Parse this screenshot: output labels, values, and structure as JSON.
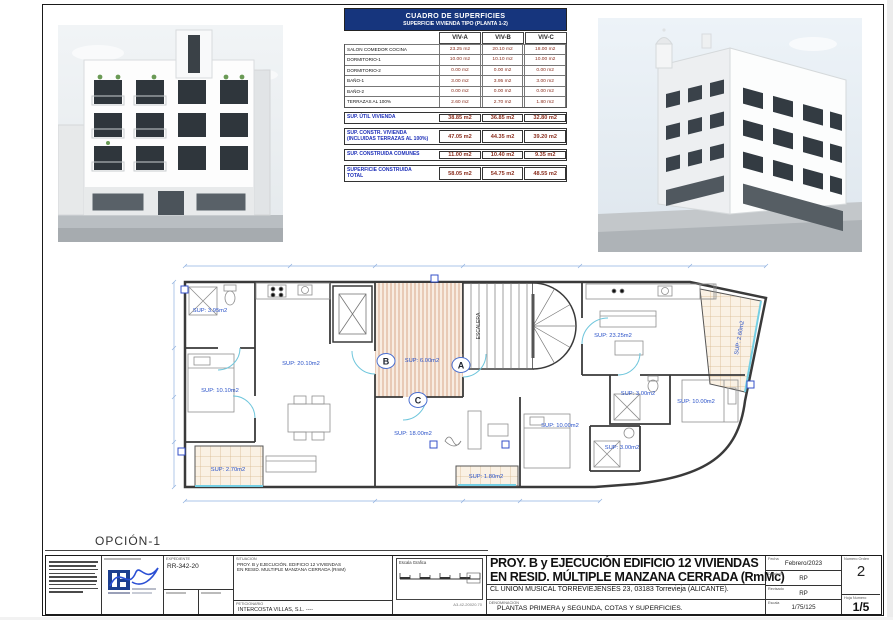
{
  "page": {
    "option_label": "OPCIÓN-1",
    "sheet_code": "A3-42-20020.70"
  },
  "surface_table": {
    "title": "CUADRO DE SUPERFICIES",
    "subtitle": "SUPERFICIE VIVIENDA TIPO  (PLANTA 1-2)",
    "columns": [
      "VIV-A",
      "VIV-B",
      "VIV-C"
    ],
    "rows": [
      {
        "label": "SALON COMEDOR COCINA",
        "values": [
          "23.25 m2",
          "20.10 m2",
          "18.00 m2"
        ]
      },
      {
        "label": "DORMITORIO-1",
        "values": [
          "10.00 m2",
          "10.10 m2",
          "10.00 m2"
        ]
      },
      {
        "label": "DORMITORIO-2",
        "values": [
          "0.00 m2",
          "0.00 m2",
          "0.00 m2"
        ]
      },
      {
        "label": "BAÑO-1",
        "values": [
          "3.00 m2",
          "3.95 m2",
          "3.00 m2"
        ]
      },
      {
        "label": "BAÑO-2",
        "values": [
          "0.00 m2",
          "0.00 m2",
          "0.00 m2"
        ]
      },
      {
        "label": "TERRAZAS AL 100%",
        "values": [
          "2.60 m2",
          "2.70 m2",
          "1.80 m2"
        ]
      }
    ],
    "summary": [
      {
        "label": "SUP. ÚTIL VIVIENDA",
        "label2": "",
        "values": [
          "38.85 m2",
          "36.85 m2",
          "32.80 m2"
        ]
      },
      {
        "label": "SUP. CONSTR. VIVIENDA",
        "label2": "(INCLUIDAS TERRAZAS AL 100%)",
        "values": [
          "47.05 m2",
          "44.35 m2",
          "39.20 m2"
        ]
      },
      {
        "label": "SUP. CONSTRUIDA COMUNES",
        "label2": "",
        "values": [
          "11.00 m2",
          "10.40 m2",
          "9.35 m2"
        ]
      },
      {
        "label": "SUPERFICIE CONSTRUIDA",
        "label2": "TOTAL",
        "values": [
          "58.05 m2",
          "54.75 m2",
          "48.55 m2"
        ]
      }
    ]
  },
  "plan": {
    "stair_label": "ESCALERA",
    "door_tags": [
      "A",
      "B",
      "C"
    ],
    "labels": {
      "bath_b": "SUP: 3.95m2",
      "bedroom_b": "SUP: 10.10m2",
      "terrace_b": "SUP: 2.70m2",
      "salon_b": "SUP: 20.10m2",
      "hall": "SUP: 6.00m2",
      "salon_a": "SUP: 23.25m2",
      "terrace_a": "SUP: 2.60m2",
      "bath_a": "SUP: 3.00m2",
      "bedroom_a": "SUP: 10.00m2",
      "salon_c": "SUP: 18.00m2",
      "bedroom_c": "SUP: 10.00m2",
      "bath_c": "SUP: 3.00m2",
      "terrace_c": "SUP: 1.80m2"
    }
  },
  "titleblock": {
    "expediente_label": "EXPEDIENTE",
    "expediente": "RR-342-20",
    "situacion_label": "SITUACION",
    "project_small_1": "PROY. B y EJECUCIÓN. EDIFICIO 12 VIVIENDAS",
    "project_small_2": "EN RESID. MULTIPLE MANZANA CERRADA (RmM)",
    "peticionario_label": "PETICIONARIO",
    "peticionario": "INTERCOSTA VILLAS, S.L. ----",
    "scale_bar_label": "Escala Grafica",
    "title_line1": "PROY. B y EJECUCIÓN  EDIFICIO 12 VIVIENDAS",
    "title_line2": "EN RESID. MÚLTIPLE MANZANA CERRADA (RmMc)",
    "address": "CL UNION MUSICAL TORREVIEJENSES 23, 03183  Torrevieja (ALICANTE).",
    "denominacion_label": "DENOMINACION",
    "denominacion": "PLANTAS PRIMERA y SEGUNDA, COTAS Y SUPERFICIES.",
    "fecha_label": "Fecha",
    "fecha": "Febrero/2023",
    "dibujado_label": "Dibujado",
    "dibujado": "RP",
    "revisado_label": "Revisado",
    "revisado": "RP",
    "escala_label": "Escala",
    "escala": "1/75/125",
    "numero_orden_label": "Numero Orden",
    "numero_orden": "2",
    "hoja_label": "Hoja Numero",
    "hoja": "1/5"
  }
}
